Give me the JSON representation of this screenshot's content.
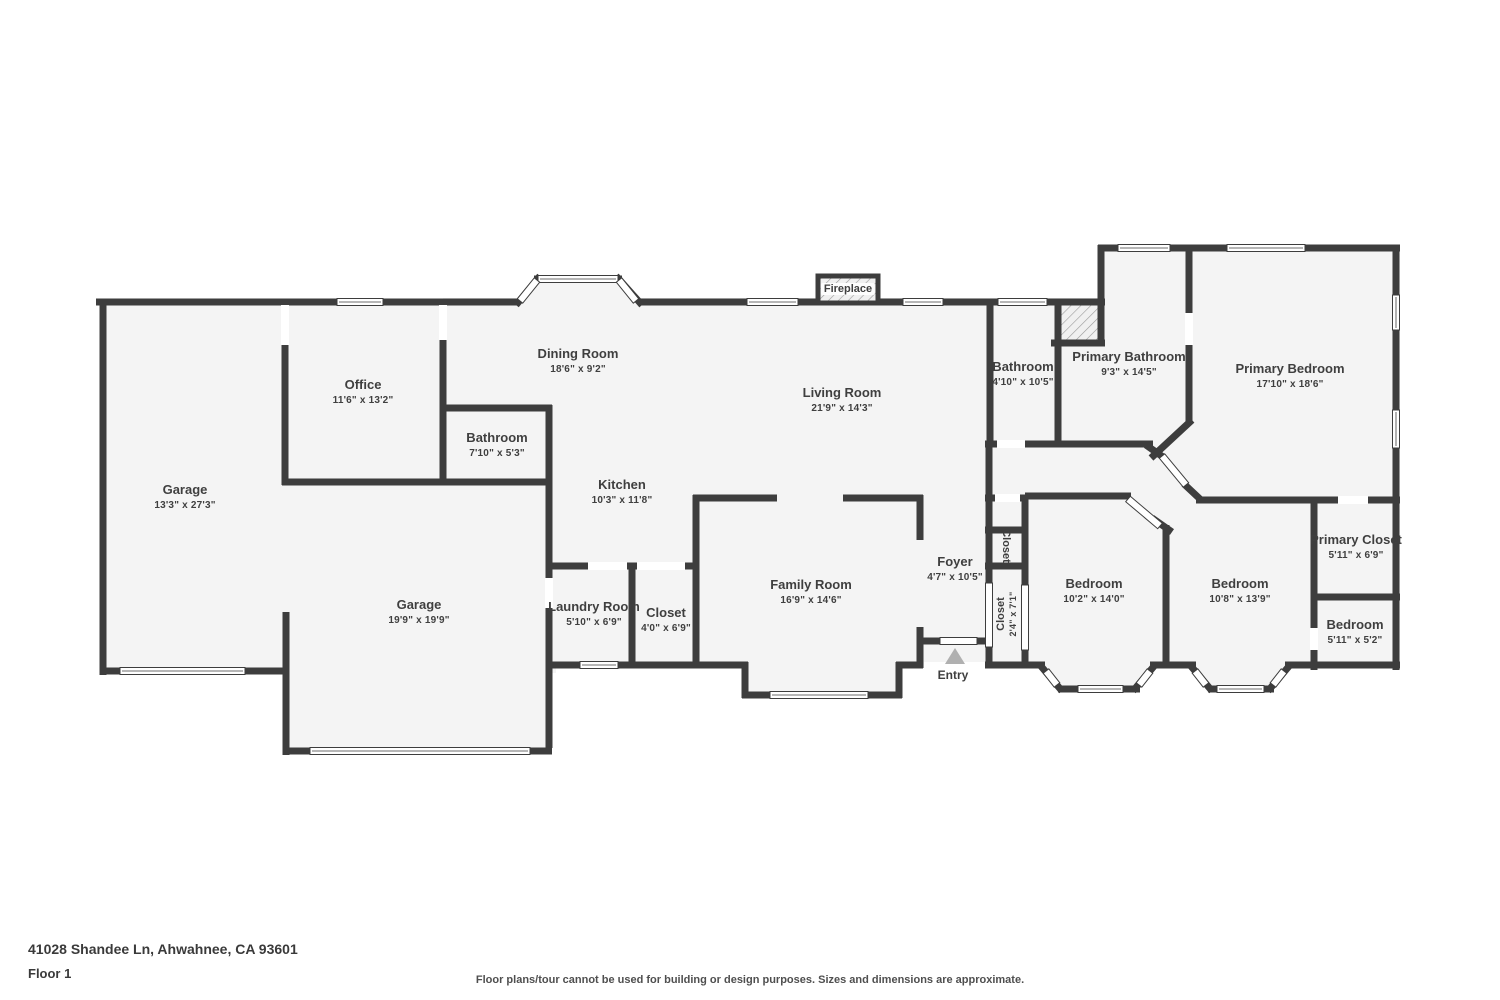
{
  "plan": {
    "rooms": [
      {
        "name": "Garage",
        "dims": "13'3\" x 27'3\""
      },
      {
        "name": "Office",
        "dims": "11'6\" x 13'2\""
      },
      {
        "name": "Dining Room",
        "dims": "18'6\" x 9'2\""
      },
      {
        "name": "Bathroom",
        "dims": "7'10\" x 5'3\""
      },
      {
        "name": "Living Room",
        "dims": "21'9\" x 14'3\""
      },
      {
        "name": "Kitchen",
        "dims": "10'3\" x 11'8\""
      },
      {
        "name": "Garage",
        "dims": "19'9\" x 19'9\""
      },
      {
        "name": "Laundry Room",
        "dims": "5'10\" x 6'9\""
      },
      {
        "name": "Closet",
        "dims": "4'0\" x 6'9\""
      },
      {
        "name": "Family Room",
        "dims": "16'9\" x 14'6\""
      },
      {
        "name": "Foyer",
        "dims": "4'7\" x 10'5\""
      },
      {
        "name": "Closet",
        "dims": ""
      },
      {
        "name": "Closet",
        "dims": "2'4\" x 7'1\""
      },
      {
        "name": "Bedroom",
        "dims": "10'2\" x 14'0\""
      },
      {
        "name": "Bedroom",
        "dims": "10'8\" x 13'9\""
      },
      {
        "name": "Primary Closet",
        "dims": "5'11\" x 6'9\""
      },
      {
        "name": "Bedroom",
        "dims": "5'11\" x 5'2\""
      },
      {
        "name": "Bathroom",
        "dims": "4'10\" x 10'5\""
      },
      {
        "name": "Primary Bathroom",
        "dims": "9'3\" x 14'5\""
      },
      {
        "name": "Primary Bedroom",
        "dims": "17'10\" x 18'6\""
      }
    ],
    "markers": {
      "fireplace": "Fireplace",
      "entry": "Entry"
    }
  },
  "footer": {
    "address": "41028 Shandee Ln, Ahwahnee, CA 93601",
    "floor": "Floor 1",
    "disclaimer": "Floor plans/tour cannot be used for building or design purposes. Sizes and dimensions are approximate."
  },
  "colors": {
    "wall": "#3d3d3d",
    "floor": "#f4f4f4",
    "marker": "#b0b0b0"
  }
}
